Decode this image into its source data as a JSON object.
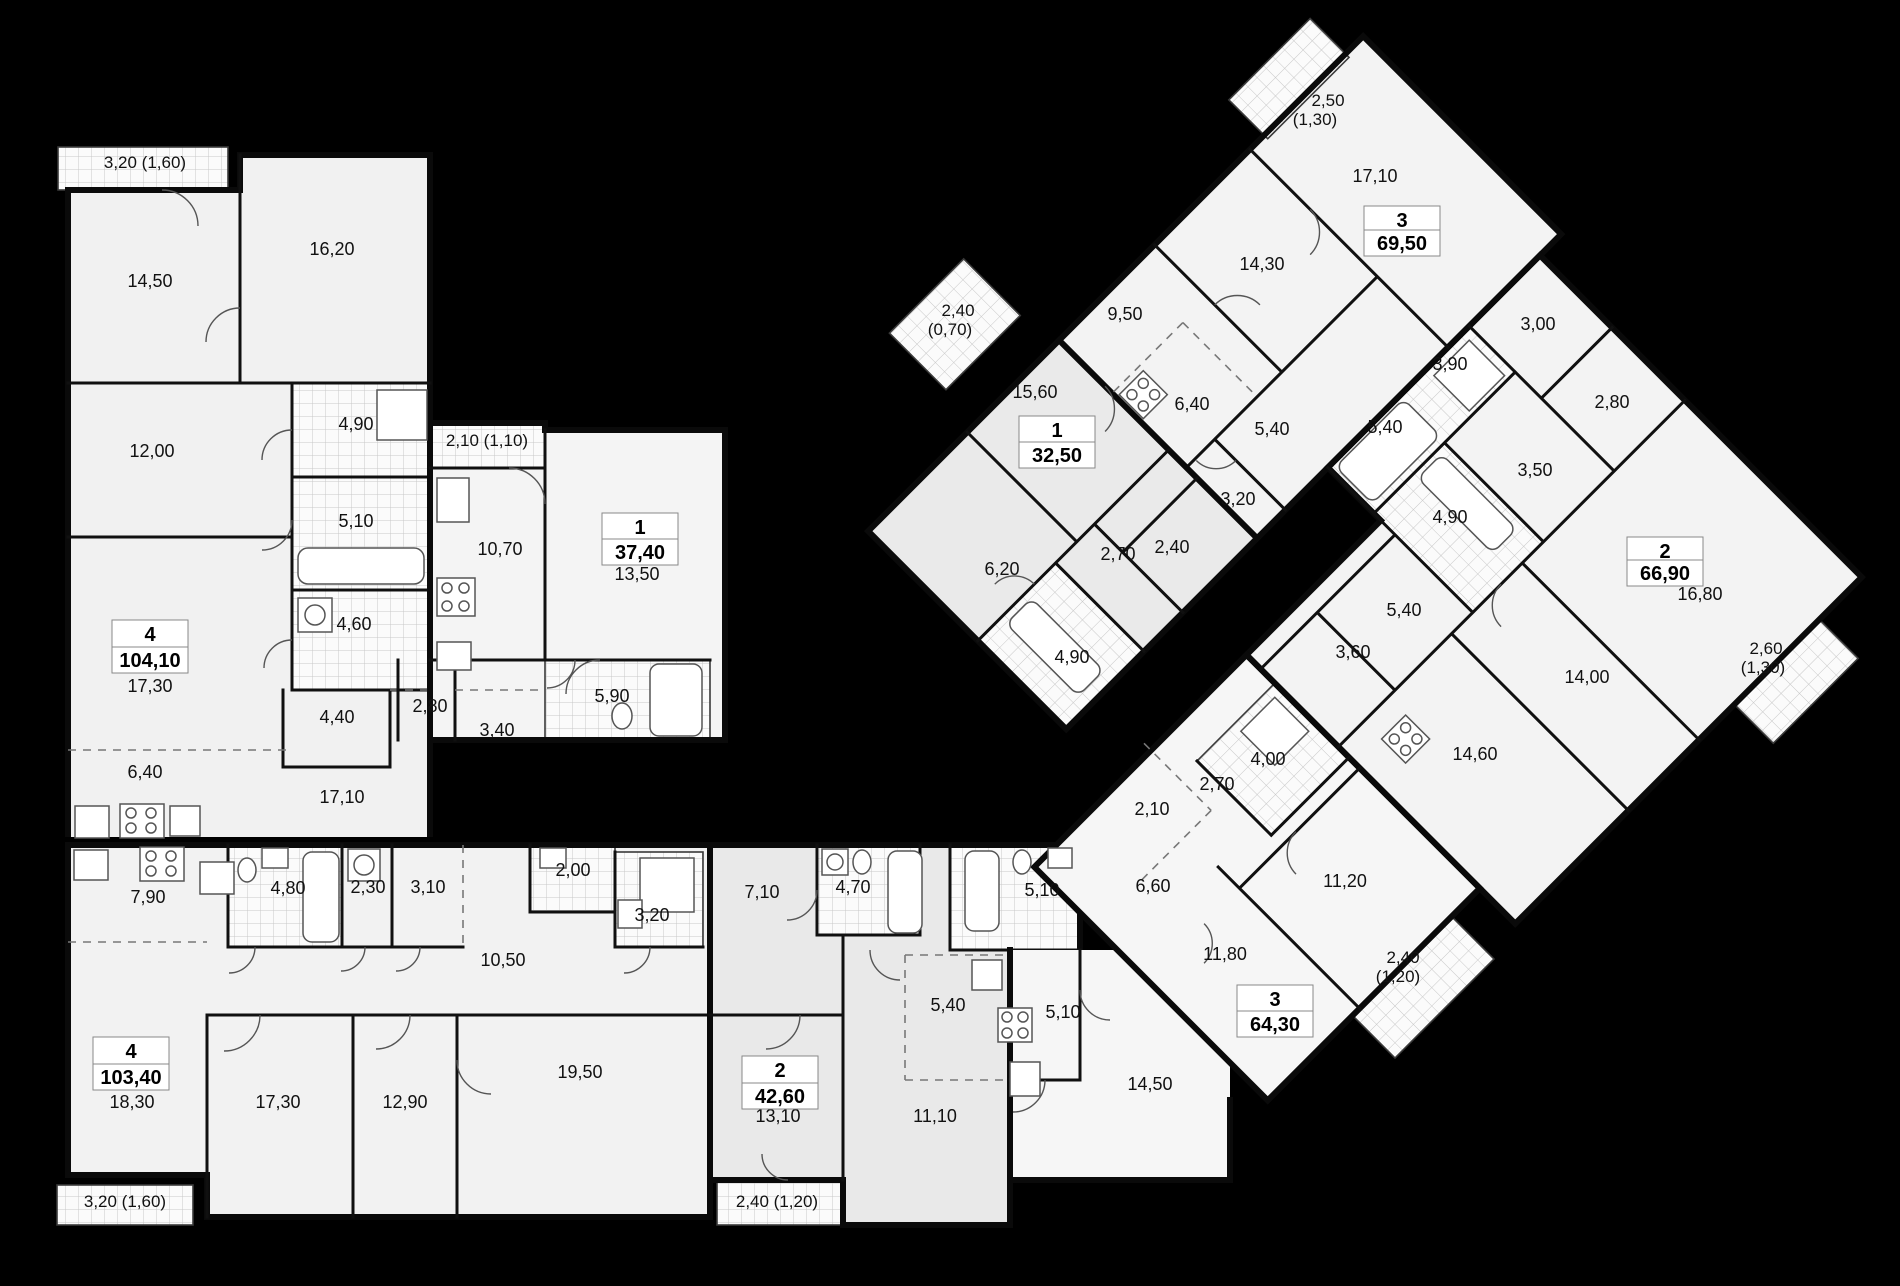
{
  "plan": {
    "background": "#000000",
    "floor_color": "#f1f1f1",
    "floor_color_alt": "#e9e9e9",
    "wall_color": "#101010",
    "hatch_color": "#c8c8c8"
  },
  "apartments": [
    {
      "rooms_count": "4",
      "total_area": "104,10"
    },
    {
      "rooms_count": "1",
      "total_area": "37,40"
    },
    {
      "rooms_count": "4",
      "total_area": "103,40"
    },
    {
      "rooms_count": "2",
      "total_area": "42,60"
    },
    {
      "rooms_count": "3",
      "total_area": "64,30"
    },
    {
      "rooms_count": "1",
      "total_area": "32,50"
    },
    {
      "rooms_count": "3",
      "total_area": "69,50"
    },
    {
      "rooms_count": "2",
      "total_area": "66,90"
    }
  ],
  "badges": [
    {
      "num": "4",
      "area": "104,10",
      "x": 150,
      "ny": 634,
      "ay": 660
    },
    {
      "num": "1",
      "area": "37,40",
      "x": 640,
      "ny": 527,
      "ay": 552
    },
    {
      "num": "4",
      "area": "103,40",
      "x": 131,
      "ny": 1051,
      "ay": 1077
    },
    {
      "num": "2",
      "area": "42,60",
      "x": 780,
      "ny": 1070,
      "ay": 1096
    },
    {
      "num": "3",
      "area": "64,30",
      "x": 1275,
      "ny": 999,
      "ay": 1024
    },
    {
      "num": "1",
      "area": "32,50",
      "x": 1057,
      "ny": 430,
      "ay": 455
    },
    {
      "num": "3",
      "area": "69,50",
      "x": 1402,
      "ny": 220,
      "ay": 243
    },
    {
      "num": "2",
      "area": "66,90",
      "x": 1665,
      "ny": 551,
      "ay": 573
    }
  ],
  "labels": [
    {
      "t": "3,20 (1,60)",
      "x": 145,
      "y": 168,
      "s": 1
    },
    {
      "t": "14,50",
      "x": 150,
      "y": 287
    },
    {
      "t": "16,20",
      "x": 332,
      "y": 255
    },
    {
      "t": "12,00",
      "x": 152,
      "y": 457
    },
    {
      "t": "4,90",
      "x": 356,
      "y": 430
    },
    {
      "t": "2,10 (1,10)",
      "x": 487,
      "y": 446,
      "s": 1
    },
    {
      "t": "5,10",
      "x": 356,
      "y": 527
    },
    {
      "t": "10,70",
      "x": 500,
      "y": 555
    },
    {
      "t": "13,50",
      "x": 637,
      "y": 580
    },
    {
      "t": "4,60",
      "x": 354,
      "y": 630
    },
    {
      "t": "17,30",
      "x": 150,
      "y": 692
    },
    {
      "t": "4,40",
      "x": 337,
      "y": 723
    },
    {
      "t": "2,80",
      "x": 430,
      "y": 712
    },
    {
      "t": "3,40",
      "x": 497,
      "y": 736
    },
    {
      "t": "5,90",
      "x": 612,
      "y": 702
    },
    {
      "t": "6,40",
      "x": 145,
      "y": 778
    },
    {
      "t": "17,10",
      "x": 342,
      "y": 803
    },
    {
      "t": "7,90",
      "x": 148,
      "y": 903
    },
    {
      "t": "4,80",
      "x": 288,
      "y": 894
    },
    {
      "t": "2,30",
      "x": 368,
      "y": 893
    },
    {
      "t": "3,10",
      "x": 428,
      "y": 893
    },
    {
      "t": "2,00",
      "x": 573,
      "y": 876
    },
    {
      "t": "3,20",
      "x": 652,
      "y": 921
    },
    {
      "t": "10,50",
      "x": 503,
      "y": 966
    },
    {
      "t": "18,30",
      "x": 132,
      "y": 1108
    },
    {
      "t": "17,30",
      "x": 278,
      "y": 1108
    },
    {
      "t": "12,90",
      "x": 405,
      "y": 1108
    },
    {
      "t": "19,50",
      "x": 580,
      "y": 1078
    },
    {
      "t": "3,20 (1,60)",
      "x": 125,
      "y": 1207,
      "s": 1
    },
    {
      "t": "7,10",
      "x": 762,
      "y": 898
    },
    {
      "t": "4,70",
      "x": 853,
      "y": 893
    },
    {
      "t": "5,10",
      "x": 1042,
      "y": 896
    },
    {
      "t": "13,10",
      "x": 778,
      "y": 1122
    },
    {
      "t": "11,10",
      "x": 935,
      "y": 1122
    },
    {
      "t": "5,40",
      "x": 948,
      "y": 1011
    },
    {
      "t": "5,10",
      "x": 1063,
      "y": 1018
    },
    {
      "t": "2,40 (1,20)",
      "x": 777,
      "y": 1207,
      "s": 1
    },
    {
      "t": "2,10",
      "x": 1152,
      "y": 815
    },
    {
      "t": "2,70",
      "x": 1217,
      "y": 790
    },
    {
      "t": "4,00",
      "x": 1268,
      "y": 765
    },
    {
      "t": "6,60",
      "x": 1153,
      "y": 892
    },
    {
      "t": "11,20",
      "x": 1345,
      "y": 887
    },
    {
      "t": "11,80",
      "x": 1225,
      "y": 960
    },
    {
      "t": "14,50",
      "x": 1150,
      "y": 1090
    },
    {
      "t": "2,40",
      "x": 1403,
      "y": 963,
      "s": 1
    },
    {
      "t": "(1,20)",
      "x": 1398,
      "y": 982,
      "s": 1
    },
    {
      "t": "2,40",
      "x": 958,
      "y": 316,
      "s": 1
    },
    {
      "t": "(0,70)",
      "x": 950,
      "y": 335,
      "s": 1
    },
    {
      "t": "15,60",
      "x": 1035,
      "y": 398
    },
    {
      "t": "6,20",
      "x": 1002,
      "y": 575
    },
    {
      "t": "2,70",
      "x": 1118,
      "y": 560
    },
    {
      "t": "2,40",
      "x": 1172,
      "y": 553
    },
    {
      "t": "4,90",
      "x": 1072,
      "y": 663
    },
    {
      "t": "2,50",
      "x": 1328,
      "y": 106,
      "s": 1
    },
    {
      "t": "(1,30)",
      "x": 1315,
      "y": 125,
      "s": 1
    },
    {
      "t": "17,10",
      "x": 1375,
      "y": 182
    },
    {
      "t": "14,30",
      "x": 1262,
      "y": 270
    },
    {
      "t": "9,50",
      "x": 1125,
      "y": 320
    },
    {
      "t": "6,40",
      "x": 1192,
      "y": 410
    },
    {
      "t": "5,40",
      "x": 1272,
      "y": 435
    },
    {
      "t": "3,20",
      "x": 1238,
      "y": 505
    },
    {
      "t": "3,00",
      "x": 1538,
      "y": 330
    },
    {
      "t": "3,90",
      "x": 1450,
      "y": 370
    },
    {
      "t": "2,80",
      "x": 1612,
      "y": 408
    },
    {
      "t": "5,40",
      "x": 1385,
      "y": 433
    },
    {
      "t": "3,50",
      "x": 1535,
      "y": 476
    },
    {
      "t": "4,90",
      "x": 1450,
      "y": 523
    },
    {
      "t": "16,80",
      "x": 1700,
      "y": 600
    },
    {
      "t": "2,60",
      "x": 1766,
      "y": 654,
      "s": 1
    },
    {
      "t": "(1,30)",
      "x": 1763,
      "y": 673,
      "s": 1
    },
    {
      "t": "14,00",
      "x": 1587,
      "y": 683
    },
    {
      "t": "5,40",
      "x": 1404,
      "y": 616
    },
    {
      "t": "3,60",
      "x": 1353,
      "y": 658
    },
    {
      "t": "14,60",
      "x": 1475,
      "y": 760
    }
  ]
}
